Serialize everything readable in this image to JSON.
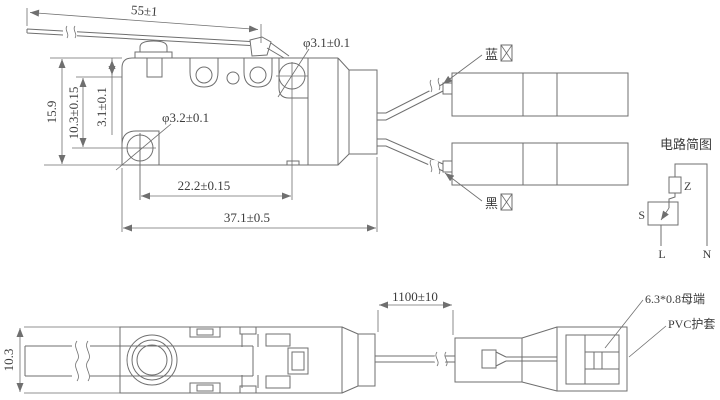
{
  "colors": {
    "line": "#6f6f6f",
    "text": "#3c3c3c",
    "background": "#ffffff"
  },
  "top_view": {
    "dims": {
      "lever_length": "55±1",
      "body_height": "15.9",
      "hole_offset": "10.3±0.15",
      "plunger_offset": "3.1±0.1",
      "top_hole_dia": "φ3.1±0.1",
      "bottom_hole_dia": "φ3.2±0.1",
      "hole_spacing": "22.2±0.15",
      "total_length": "37.1±0.5"
    },
    "wires": {
      "blue_label": "蓝",
      "black_label": "黑"
    }
  },
  "circuit": {
    "title": "电路简图",
    "component_z": "Z",
    "component_s": "S",
    "terminal_l": "L",
    "terminal_n": "N"
  },
  "bottom_view": {
    "dims": {
      "height": "10.3",
      "wire_length": "1100±10"
    },
    "labels": {
      "terminal": "6.3*0.8母端",
      "sheath": "PVC护套"
    }
  }
}
